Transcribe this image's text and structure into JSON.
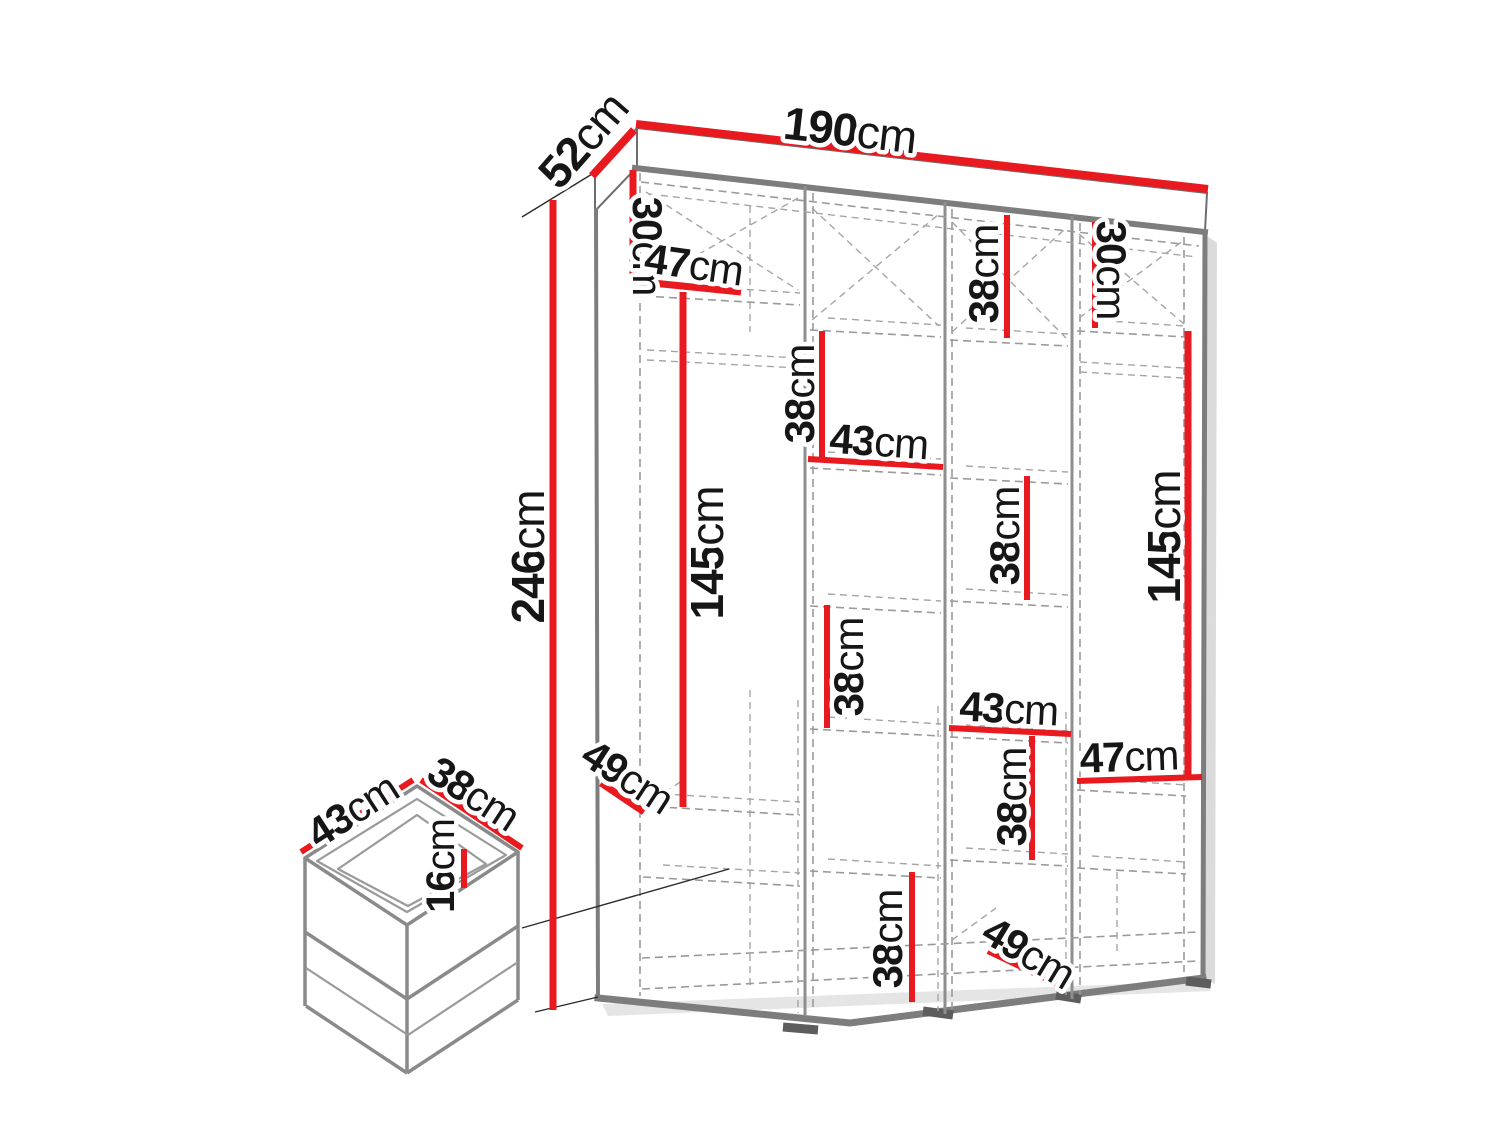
{
  "diagram": {
    "title": "wardrobe-dimension-diagram",
    "unit": "cm",
    "overall": {
      "width": {
        "num": "190",
        "unit": "cm"
      },
      "depth": {
        "num": "52",
        "unit": "cm"
      },
      "height": {
        "num": "246",
        "unit": "cm"
      }
    },
    "cabinet": {
      "col1": {
        "top_shelf_height": {
          "num": "30",
          "unit": "cm"
        },
        "section_width": {
          "num": "47",
          "unit": "cm"
        },
        "hanging_height": {
          "num": "145",
          "unit": "cm"
        },
        "shelf_depth": {
          "num": "49",
          "unit": "cm"
        }
      },
      "col2": {
        "gap_top": {
          "num": "38",
          "unit": "cm"
        },
        "width": {
          "num": "43",
          "unit": "cm"
        },
        "gap_middle": {
          "num": "38",
          "unit": "cm"
        },
        "gap_bottom": {
          "num": "38",
          "unit": "cm"
        }
      },
      "col3": {
        "gap_top": {
          "num": "38",
          "unit": "cm"
        },
        "gap_middle": {
          "num": "38",
          "unit": "cm"
        },
        "width": {
          "num": "43",
          "unit": "cm"
        },
        "gap_lower": {
          "num": "38",
          "unit": "cm"
        },
        "shelf_depth": {
          "num": "49",
          "unit": "cm"
        }
      },
      "col4": {
        "top_shelf_height": {
          "num": "30",
          "unit": "cm"
        },
        "hanging_height": {
          "num": "145",
          "unit": "cm"
        },
        "section_width": {
          "num": "47",
          "unit": "cm"
        }
      }
    },
    "drawer": {
      "width": {
        "num": "43",
        "unit": "cm"
      },
      "depth": {
        "num": "38",
        "unit": "cm"
      },
      "height": {
        "num": "16",
        "unit": "cm"
      }
    }
  }
}
